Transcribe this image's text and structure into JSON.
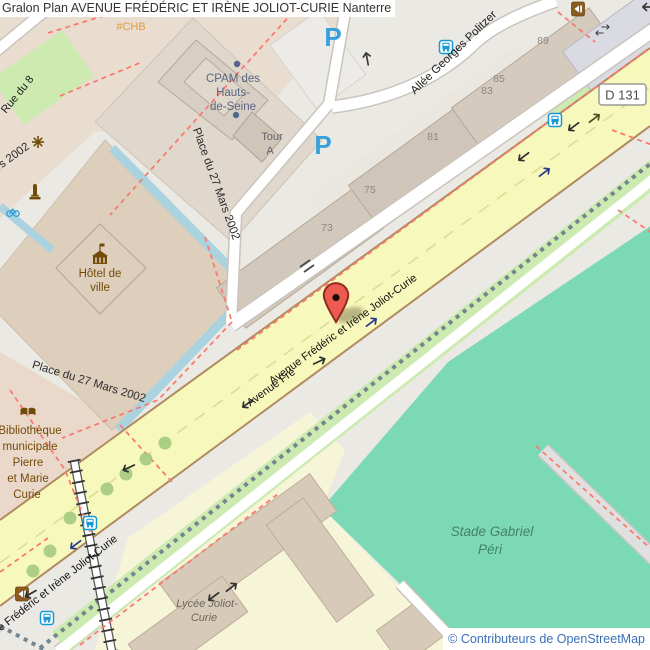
{
  "title": "Gralon  Plan AVENUE FRÉDÉRIC ET IRÈNE JOLIOT-CURIE Nanterre",
  "attribution": "© Contributeurs de OpenStreetMap",
  "roads": {
    "d131_ref": "D 131",
    "avenue": "Avenue Frédéric et Irène Joliot-Curie",
    "avenue_partial": "Avenue Fré",
    "allee": "Allée Georges Politzer",
    "place": "Place du 27 Mars 2002",
    "rue8": "Rue du 8"
  },
  "pois": {
    "cpam": {
      "line1": "CPAM des",
      "line2": "Hauts-",
      "line3": "de-Seine"
    },
    "tour": {
      "line1": "Tour",
      "line2": "A"
    },
    "hotel_de_ville": {
      "line1": "Hôtel de",
      "line2": "ville"
    },
    "bibliotheque": {
      "line1": "Bibliothèque",
      "line2": "municipale",
      "line3": "Pierre",
      "line4": "et Marie",
      "line5": "Curie"
    },
    "lycee": {
      "line1": "Lycée Joliot-",
      "line2": "Curie"
    },
    "stade": {
      "line1": "Stade Gabriel",
      "line2": "Péri"
    },
    "chb": "#CHB"
  },
  "housenumbers": {
    "h89": "89",
    "h85": "85",
    "h83": "83",
    "h81": "81",
    "h75": "75",
    "h73": "73"
  },
  "icons": {
    "parking_letter": "P",
    "marker": "map-pin",
    "bus": "bus-stop",
    "bicycle": "bicycle-parking",
    "townhall": "town-hall",
    "book": "library-book",
    "monument": "monument",
    "fountain": "fountain-star",
    "poi_door": "brown-poi"
  },
  "colors": {
    "avenue_fill": "#f7f8bb",
    "stadium_fill": "#7cd9b5",
    "grass_fill": "#cdebb0",
    "school_fill": "#f7f5d8",
    "water_fill": "#aad3df",
    "marker_red": "#ec5b4f",
    "parking_blue": "#35a0dc",
    "bus_blue": "#1899d5",
    "path_red": "#f97b6f",
    "poi_brown": "#734a08",
    "attribution_blue": "#3b6fb6"
  }
}
